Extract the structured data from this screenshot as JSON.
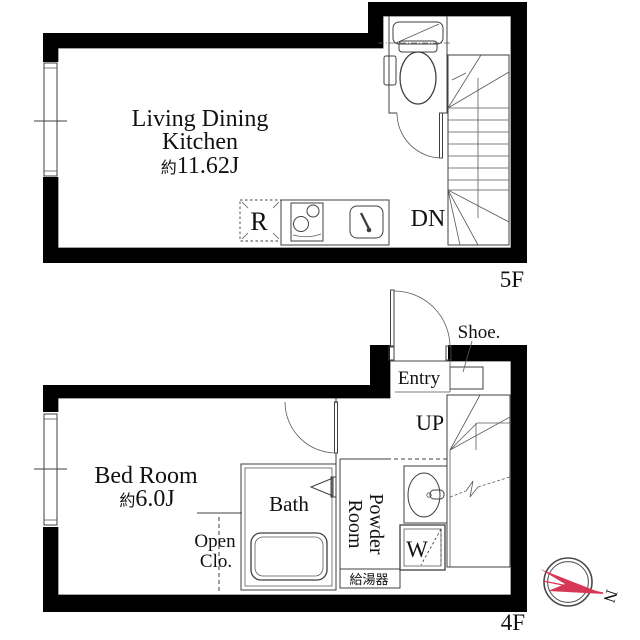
{
  "floor5": {
    "floor_label": "5F",
    "ldk": {
      "line1": "Living Dining",
      "line2": "Kitchen",
      "area_prefix": "約",
      "area_value": "11.62J"
    },
    "stairs_label": "DN",
    "fridge_label": "R"
  },
  "floor4": {
    "floor_label": "4F",
    "bedroom": {
      "name": "Bed Room",
      "area_prefix": "約",
      "area_value": "6.0J"
    },
    "bath_label": "Bath",
    "open_closet": {
      "line1": "Open",
      "line2": "Clo."
    },
    "powder_room": {
      "line1": "Powder",
      "line2": "Room"
    },
    "washer_label": "W",
    "water_heater_label": "給湯器",
    "entry_label": "Entry",
    "shoe_label": "Shoe.",
    "stairs_label": "UP"
  },
  "compass": {
    "north_label": "N"
  },
  "colors": {
    "wall": "#000000",
    "line": "#3f3f3f",
    "accent_red": "#d63757"
  }
}
